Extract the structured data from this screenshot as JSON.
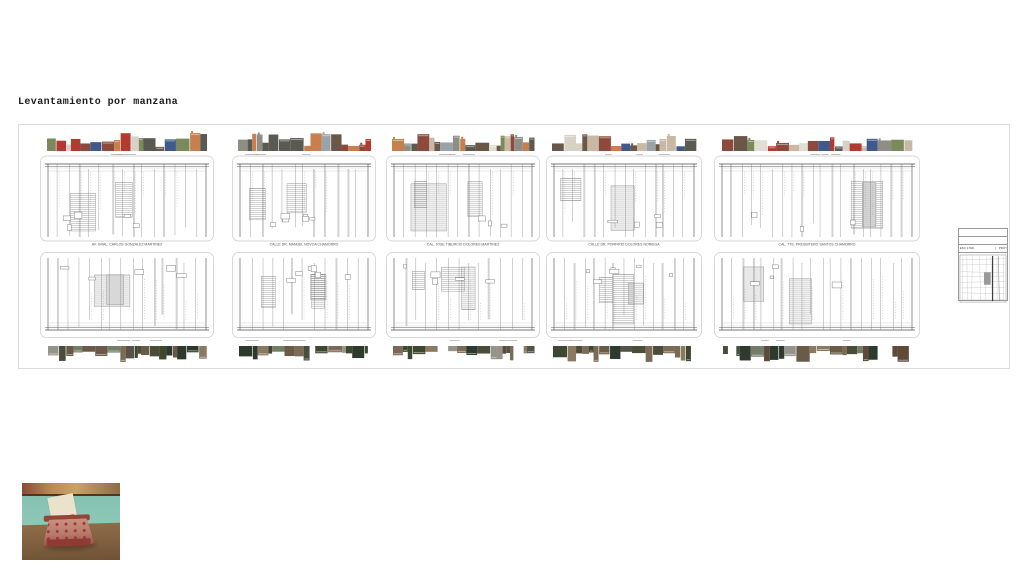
{
  "title": "Levantamiento por manzana",
  "sheet": {
    "blocks": [
      {
        "street": "AV. GRAL. CARLOS GONZALEZ MARTINEZ"
      },
      {
        "street": "CALLE DR. MANUEL NOVOA CHAMORRO"
      },
      {
        "street": "CAL. JOSE TIBURCIO DOLORES MARTINEZ"
      },
      {
        "street": "CALLE DR. PORFIRIO DOLORES NORIEGA"
      },
      {
        "street": "CAL. TTE. PRESBITERO SANTOS CHAMORRO"
      }
    ],
    "legend": {
      "line1": "SECTOR HERMANA ANILLO",
      "line2": "ZONA REGULACION CUARTEL",
      "scale": "ESC 1:500",
      "project": "PROYECTO V"
    }
  },
  "colors": {
    "sheet_border": "#dcdcdc",
    "plan_line_dark": "#4a4a4a",
    "plan_line_mid": "#787878",
    "plan_line_light": "#c9c9c9",
    "facade_palette": [
      "#8d4a3c",
      "#c9b9a4",
      "#8e8e86",
      "#d8d2c6",
      "#5a5a52",
      "#b33a2e",
      "#3f5a8a",
      "#7a8a5a",
      "#c87f4f",
      "#e2ddd3",
      "#6b5747",
      "#9aa4a8"
    ],
    "street_photo_palette": [
      "#6a5a48",
      "#4a4d3a",
      "#7b6b54",
      "#3e472f",
      "#8a7a62",
      "#55524a",
      "#2f3a2f",
      "#96938a",
      "#5d4a38",
      "#737d6a"
    ],
    "photo": {
      "wall": "#85c2b2",
      "table_top": "#8f6c49",
      "table_bottom": "#6d5134",
      "shelf_left": "#8a4a38",
      "shelf_mid": "#c9a267",
      "shelf_edge": "#4e3624",
      "typewriter_body": "#bd8275",
      "typewriter_front": "#8e3b33",
      "keys": "#a03a30",
      "paper": "#eae3cb"
    }
  }
}
